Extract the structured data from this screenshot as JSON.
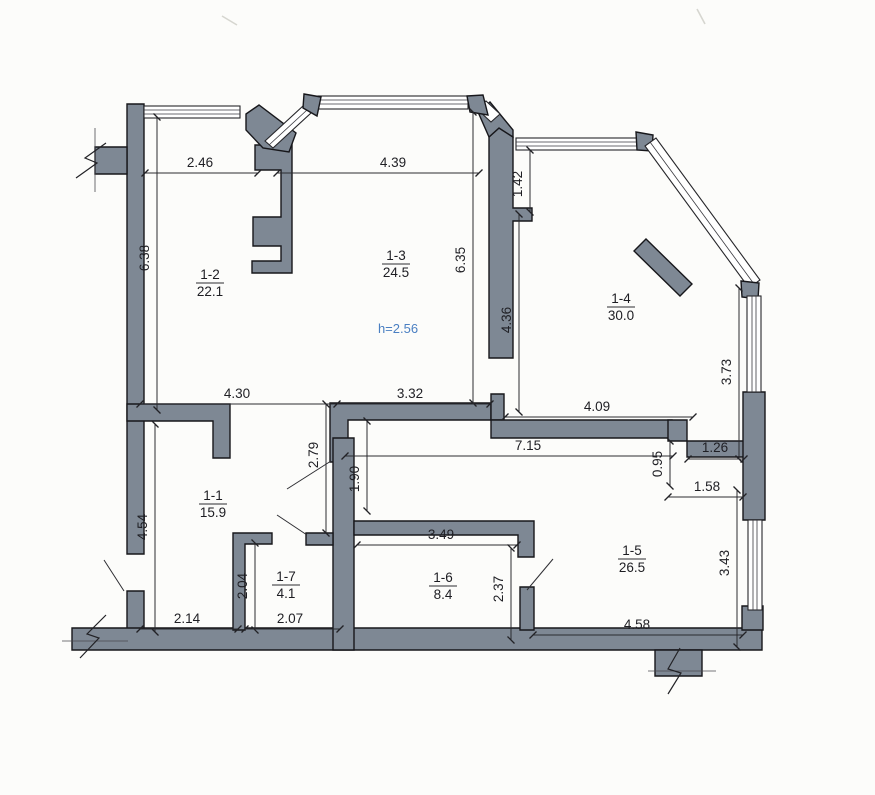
{
  "rooms": {
    "r11": {
      "id": "1-1",
      "area": "15.9"
    },
    "r12": {
      "id": "1-2",
      "area": "22.1"
    },
    "r13": {
      "id": "1-3",
      "area": "24.5"
    },
    "r14": {
      "id": "1-4",
      "area": "30.0"
    },
    "r15": {
      "id": "1-5",
      "area": "26.5"
    },
    "r16": {
      "id": "1-6",
      "area": "8.4"
    },
    "r17": {
      "id": "1-7",
      "area": "4.1"
    }
  },
  "ceiling_height": {
    "label": "h=2.56",
    "color": "#4a7fc2"
  },
  "dimensions": {
    "top_room12_width": "2.46",
    "top_room13_width": "4.39",
    "window_room14_left": "1.42",
    "room12_height": "6.38",
    "room13_height": "6.35",
    "wall_34_height": "4.36",
    "room14_right_height": "3.73",
    "mid_room11_width": "4.30",
    "mid_room13_width": "3.32",
    "mid_room14_width": "4.09",
    "corridor_length": "7.15",
    "step_width": "1.26",
    "step_height": "0.95",
    "door_room15_width": "1.58",
    "opening_left": "2.79",
    "opening_right": "1.90",
    "room11_height": "4.54",
    "room17_height": "2.04",
    "room11_bottom_width": "2.14",
    "room17_bottom_width": "2.07",
    "room16_width": "3.49",
    "room16_height": "2.37",
    "room15_bottom_width": "4.58",
    "room15_right_height": "3.43"
  },
  "colors": {
    "wall": "#7e8894",
    "outline": "#17171b",
    "dimension_text": "#1f1f24",
    "window": "#ffffff",
    "background": "#fcfcfa"
  }
}
